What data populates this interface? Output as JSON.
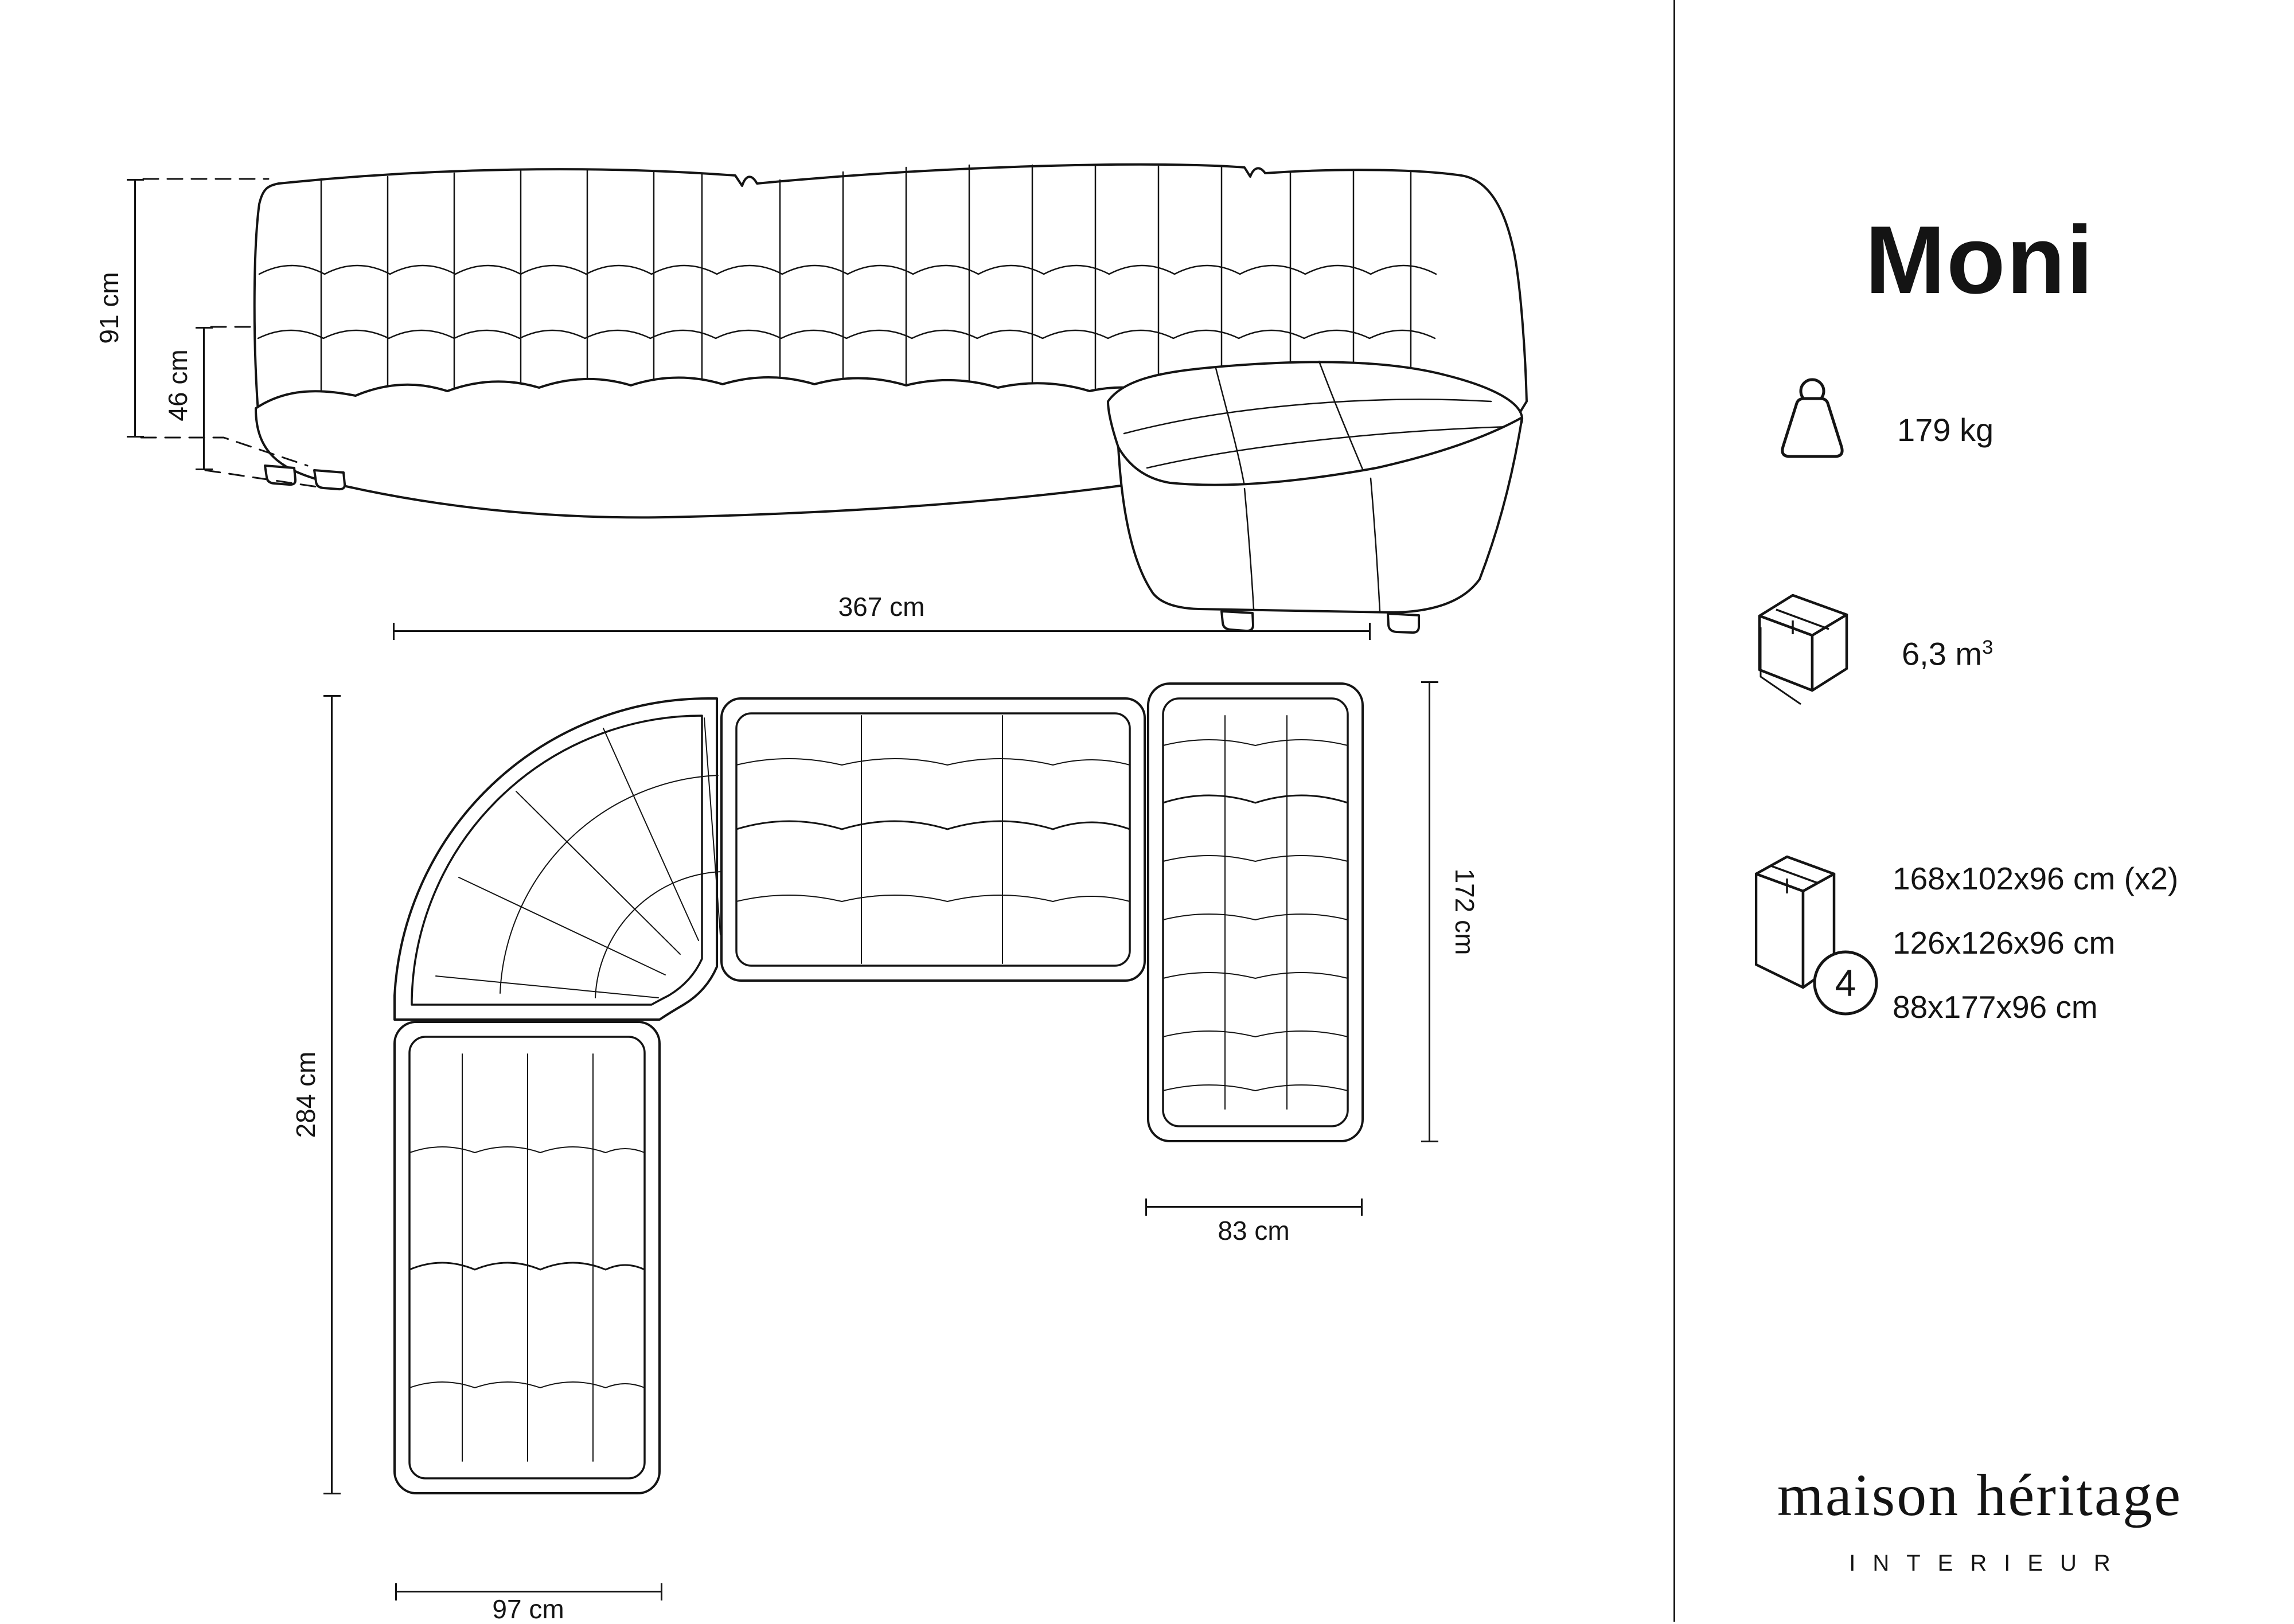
{
  "title": "Moni",
  "side_view": {
    "total_height": "91 cm",
    "seat_height": "46 cm"
  },
  "top_view": {
    "total_width": "367 cm",
    "total_depth": "284 cm",
    "chaise_length": "172 cm",
    "chaise_width": "83 cm",
    "arm_width": "97 cm"
  },
  "specs": {
    "weight": "179 kg",
    "volume_value": "6,3 m",
    "volume_exponent": "3",
    "package_count": "4",
    "packages": [
      "168x102x96 cm (x2)",
      "126x126x96 cm",
      "88x177x96 cm"
    ]
  },
  "brand": {
    "name": "maison héritage",
    "tagline": "INTERIEUR"
  },
  "colors": {
    "ink": "#141414",
    "background": "#ffffff"
  }
}
